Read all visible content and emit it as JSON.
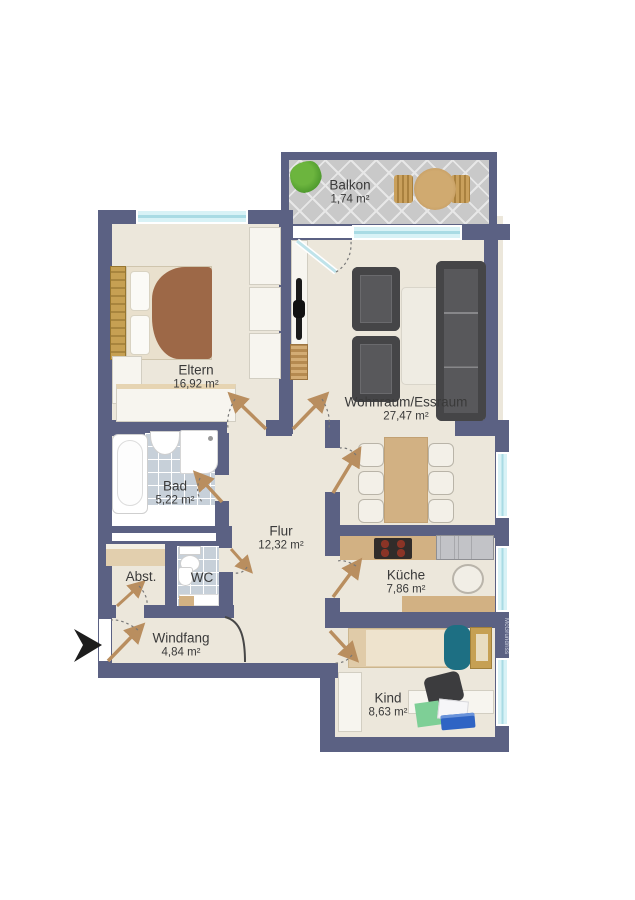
{
  "watermark": "McGrundriss",
  "rooms": {
    "balkon": {
      "name": "Balkon",
      "area": "1,74 m²"
    },
    "eltern": {
      "name": "Eltern",
      "area": "16,92 m²"
    },
    "wohnraum": {
      "name": "Wohnraum/Essraum",
      "area": "27,47 m²"
    },
    "bad": {
      "name": "Bad",
      "area": "5,22 m²"
    },
    "flur": {
      "name": "Flur",
      "area": "12,32 m²"
    },
    "abst": {
      "name": "Abst."
    },
    "wc": {
      "name": "WC"
    },
    "kueche": {
      "name": "Küche",
      "area": "7,86 m²"
    },
    "windfang": {
      "name": "Windfang",
      "area": "4,84 m²"
    },
    "kind": {
      "name": "Kind",
      "area": "8,63 m²"
    }
  },
  "colors": {
    "wall": "#5b6183",
    "floor": "#ece7db",
    "tilebath": "#c7d0d9",
    "tilebalcony": "#c9c9c9",
    "window": "#d8f2f6",
    "wood": "#d2b183",
    "woodDark": "#c6a053",
    "doorleaf": "#b98e5f",
    "sofa": "#48484a",
    "teal": "#1d6f83",
    "blanket": "#9d6847",
    "green": "#7ecf96",
    "folderblue": "#2f64c4",
    "text": "#3a3a3a",
    "arrow": "#1d1d1d"
  }
}
